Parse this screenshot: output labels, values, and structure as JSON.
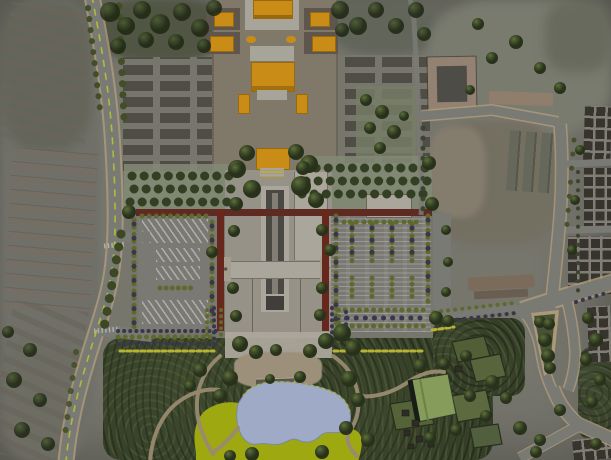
{
  "meta": {
    "kind": "architectural-site-master-plan",
    "width_px": 611,
    "height_px": 460,
    "text_on_image": "none"
  },
  "palette": {
    "base": "#8b8a80",
    "aerial2": "#7b7d6e",
    "canopy": "#5f6550",
    "road": "#8f8f88",
    "roadedge": "#d0b892",
    "dash": "#d7e23f",
    "plaza": "#968e7c",
    "platform": "#c4c0b4",
    "orange": "#eca41c",
    "orangedark": "#b57b10",
    "sideblock": "#6e6459",
    "hutground": "#8b8b7f",
    "hutblock": "#5e5a52",
    "redwall": "#7a2e23",
    "redwalltop": "#6e3228",
    "axis": "#b0ab9e",
    "walk": "#c9c3b6",
    "walkedge": "#8a8578",
    "canaldark": "#57554f",
    "canalmid": "#98948a",
    "basin": "#4b4945",
    "parking": "#8f8e88",
    "stall": "#e1e0da",
    "hedge": "#6f7d35",
    "hedgedark": "#43405a",
    "yellowdash": "#d6d23f",
    "bosque": "#97a087",
    "forest": "#3f4930",
    "forestlight": "#5f7040",
    "lawn": "#b9c514",
    "pond": "#b9c7e8",
    "pondedge": "#93a0c2",
    "pondline": "#cdd83c",
    "path": "#b3a284",
    "beach": "#b7a98f",
    "greenroof": "#9cb76b",
    "clearing": "#687747",
    "cityblock": "#413c35",
    "cityline": "#97948b",
    "tan1": "#ac9785",
    "tan2": "#a8947e",
    "brown1": "#8f7e6a",
    "medgreen": "#55603f",
    "fieldtan": "#9b9180",
    "streettree": "#4d5c2d",
    "car": "#c9b596"
  },
  "regions": {
    "north": "historic temple complex on central axis with orange-roofed halls and gate pavilions",
    "west": "existing low-rise residential fabric along curved tree-lined avenue with yellow dashed centerline",
    "center": "twin walled forecourts (red enclosure walls): west striped coach-parking court, east tree-islanded car park, flanking a sunken central canal walkway",
    "south": "landscape park with dense woodland, gravel beach, kidney-shaped pond and chartreuse lawn",
    "southeast": "park lawns, green-roof visitor building, small pavilions, Y-road junction with planted median",
    "east": "urban blocks grid and service roads, courtyard building and long farm sheds in aerial photo"
  }
}
